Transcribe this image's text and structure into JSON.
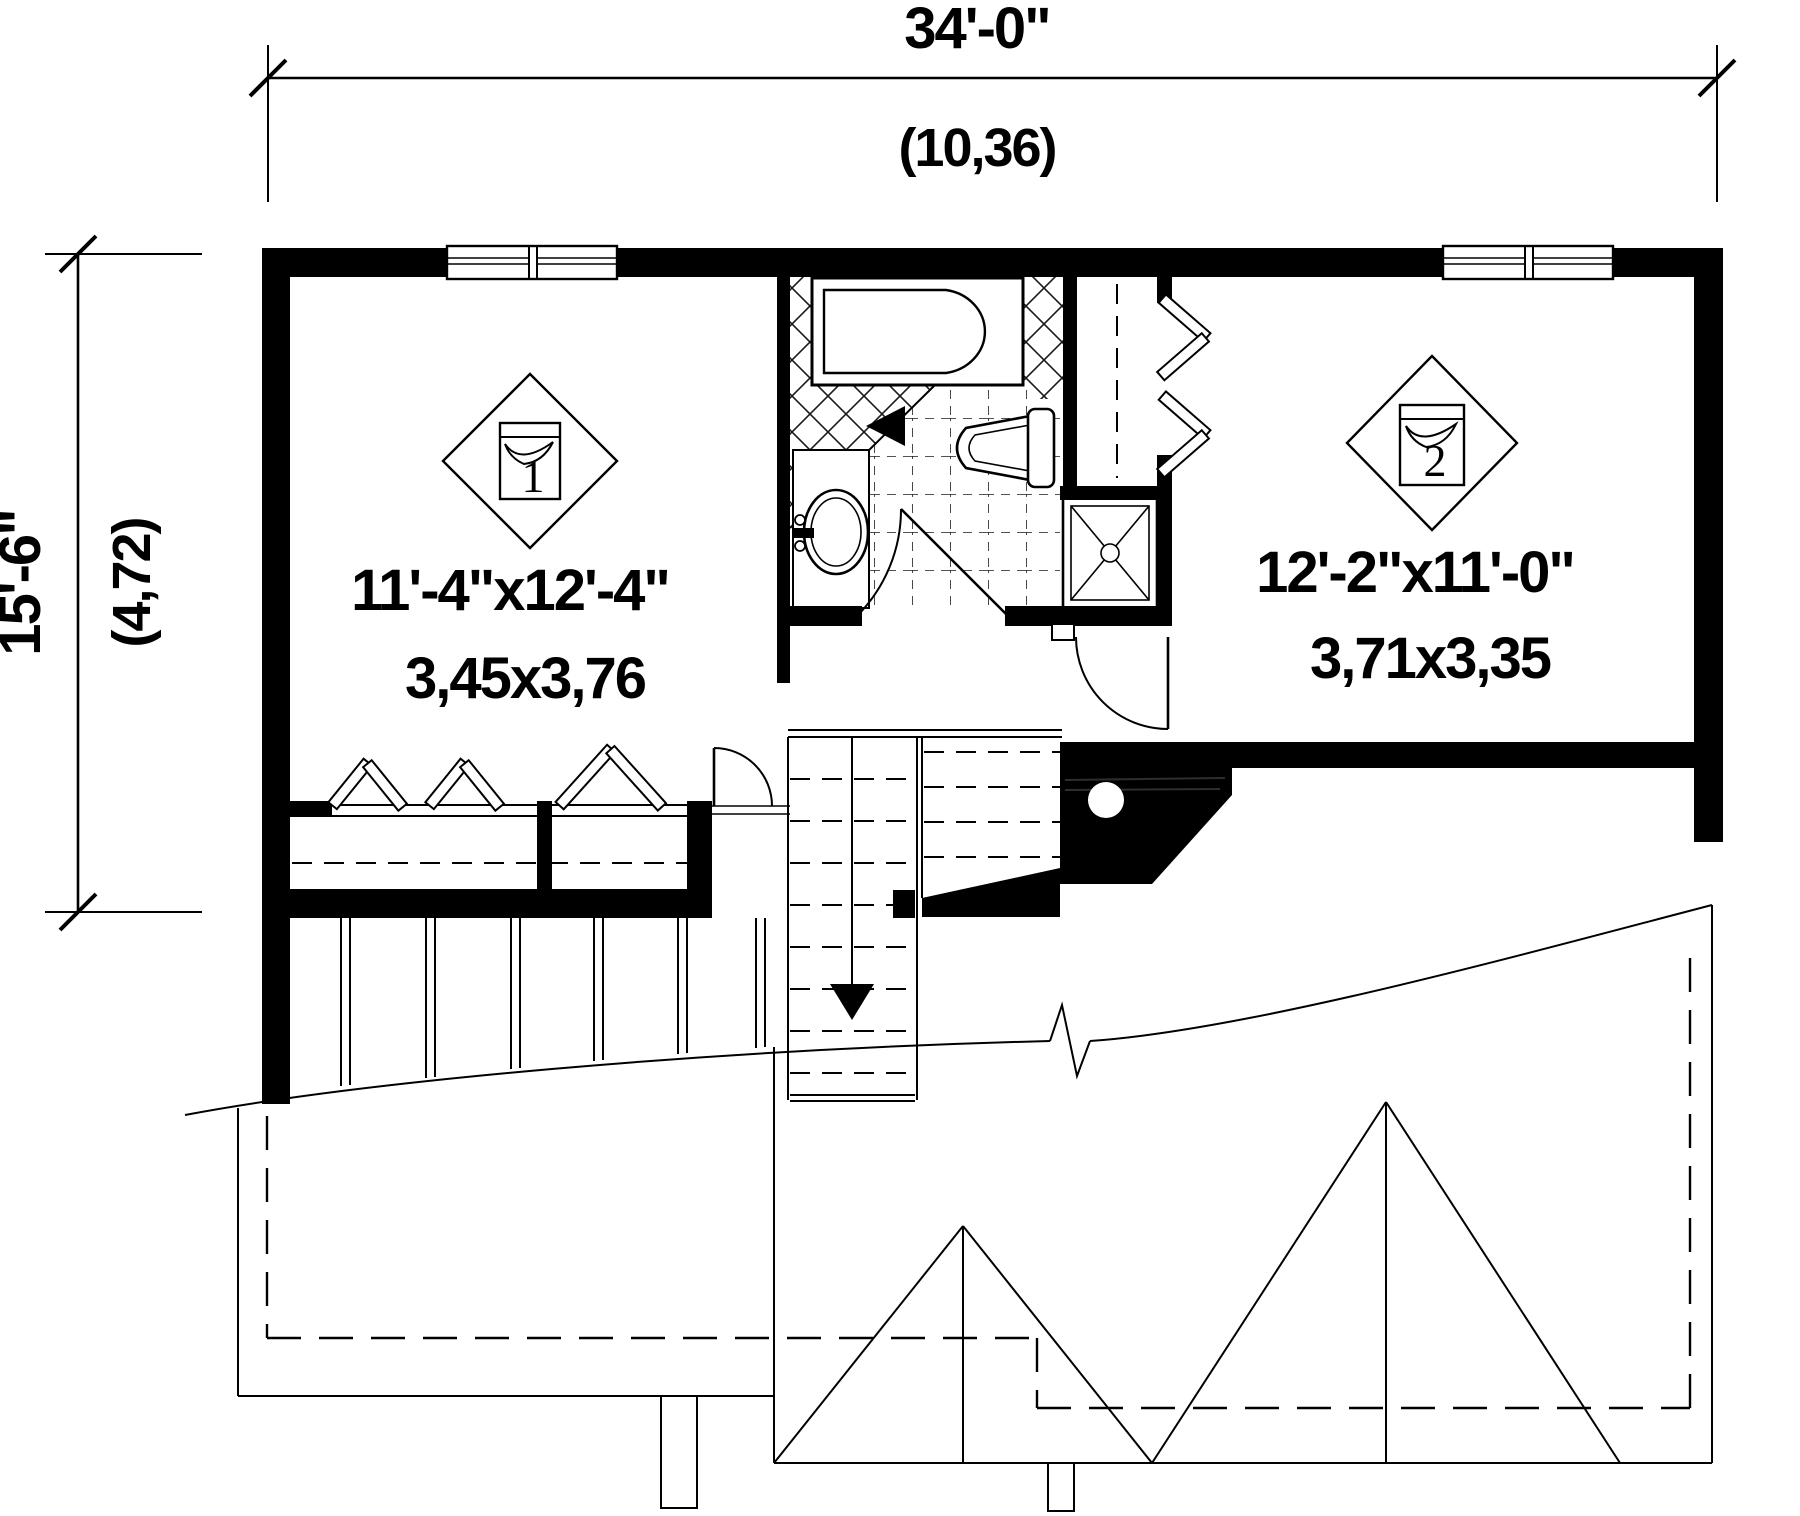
{
  "colors": {
    "ink": "#000000",
    "paper": "#ffffff"
  },
  "dimensions": {
    "top": {
      "imperial": "34'-0\"",
      "metric": "(10,36)"
    },
    "left": {
      "imperial": "15'-6\"",
      "metric": "(4,72)"
    }
  },
  "rooms": [
    {
      "number": "1",
      "imperial": "11'-4\"x12'-4\"",
      "metric": "3,45x3,76"
    },
    {
      "number": "2",
      "imperial": "12'-2\"x11'-0\"",
      "metric": "3,71x3,35"
    }
  ]
}
